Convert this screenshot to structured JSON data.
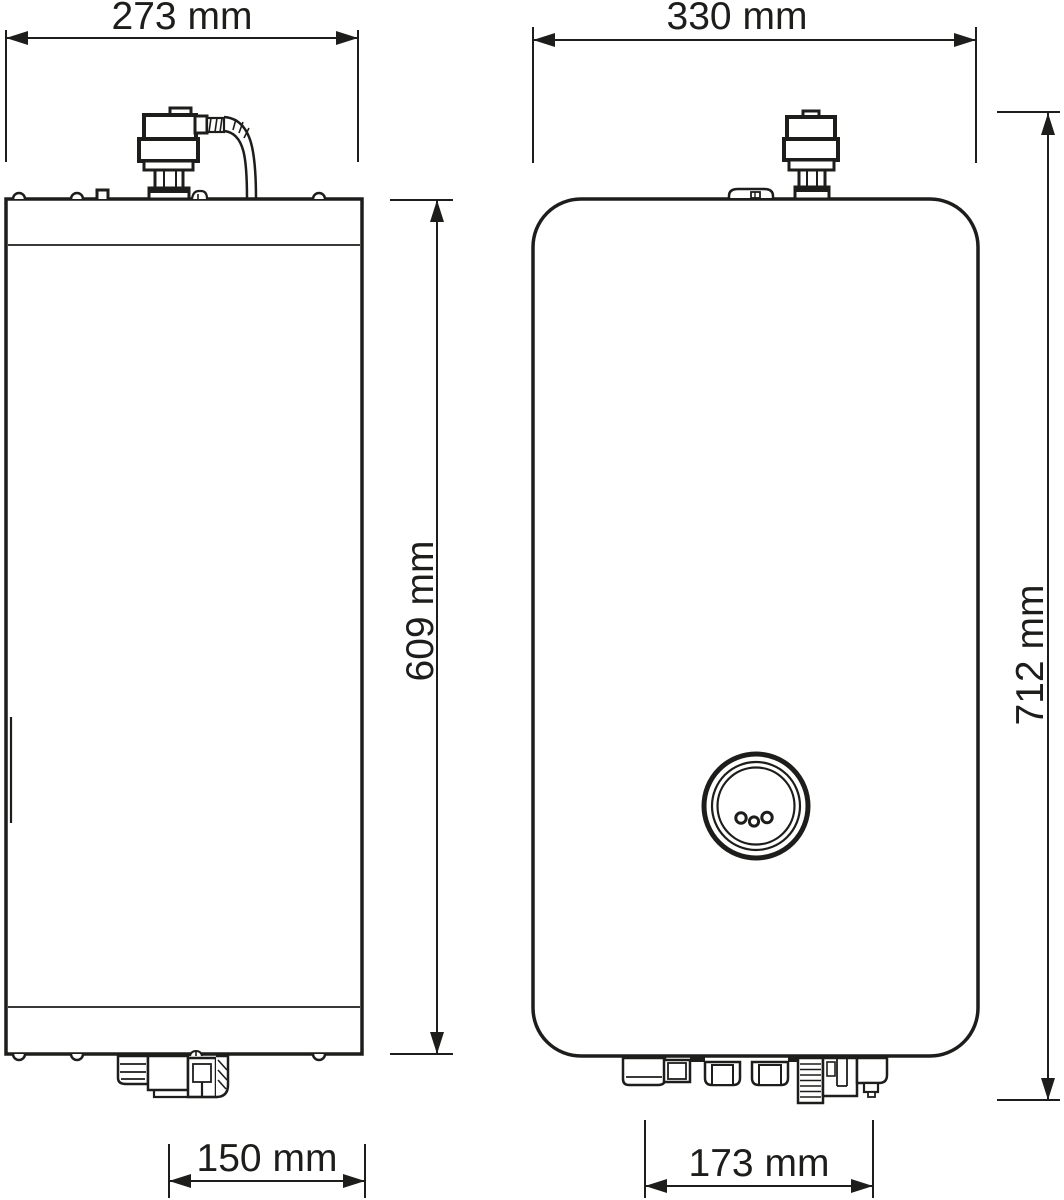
{
  "dimensions": {
    "side_width": {
      "label": "273 mm",
      "value": 273,
      "unit": "mm"
    },
    "front_width": {
      "label": "330 mm",
      "value": 330,
      "unit": "mm"
    },
    "body_height": {
      "label": "609 mm",
      "value": 609,
      "unit": "mm"
    },
    "total_height": {
      "label": "712 mm",
      "value": 712,
      "unit": "mm"
    },
    "side_bottom_width": {
      "label": "150 mm",
      "value": 150,
      "unit": "mm"
    },
    "front_bottom_width": {
      "label": "173 mm",
      "value": 173,
      "unit": "mm"
    }
  },
  "colors": {
    "line": "#1d1d1b",
    "background": "#ffffff"
  }
}
